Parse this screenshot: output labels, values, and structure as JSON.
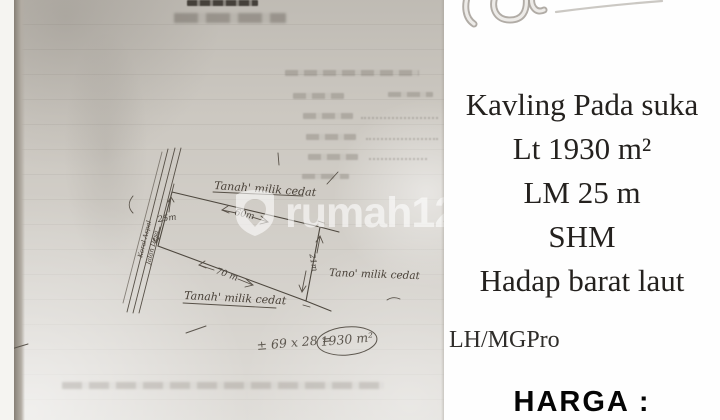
{
  "watermark": {
    "text": "rumah123"
  },
  "sketch": {
    "owner_top": "Tanah' milik cedat",
    "owner_right": "Tano' milik cedat",
    "owner_bottom": "Tanah' milik cedat",
    "dim_left": "25m",
    "dim_top": "60m",
    "dim_bottom": "70 m",
    "dim_right": "21m",
    "area_formula": "± 69 x 28 =",
    "area_result": "1930 m²",
    "road_label_line1": "Jalan Desa",
    "road_label_line2": "Koral Aspal"
  },
  "panel": {
    "lines": [
      "Kavling Pada suka",
      "Lt 1930 m²",
      "LM 25 m",
      "SHM",
      "Hadap barat laut"
    ],
    "agent_code": "LH/MGPro",
    "price_label": "HARGA :"
  }
}
